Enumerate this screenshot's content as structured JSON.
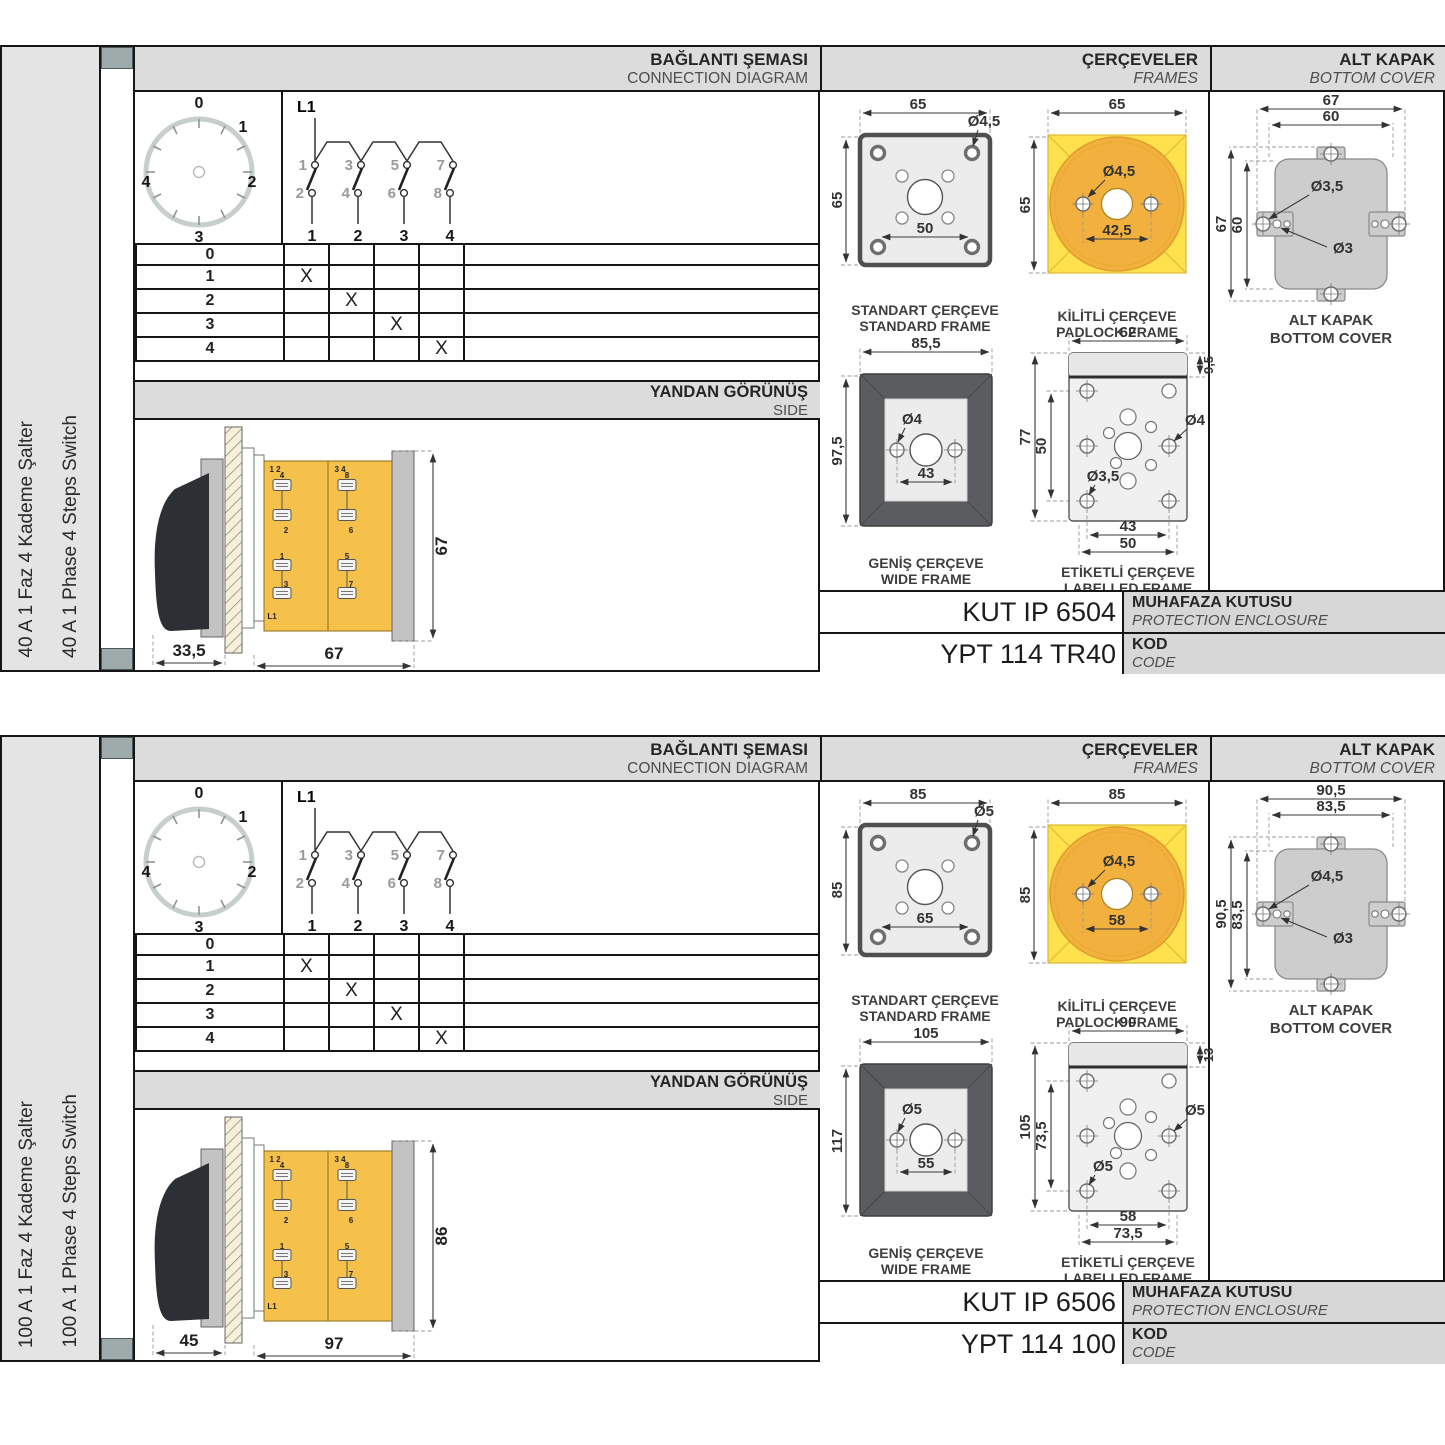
{
  "panels": [
    {
      "vertical_label_tr": "40 A 1 Faz 4 Kademe Şalter",
      "vertical_label_en": "40 A 1 Phase 4 Steps Switch",
      "headers": {
        "conn_tr": "BAĞLANTI ŞEMASI",
        "conn_en": "CONNECTION DIAGRAM",
        "frames_tr": "ÇERÇEVELER",
        "frames_en": "FRAMES",
        "cover_tr": "ALT KAPAK",
        "cover_en": "BOTTOM COVER"
      },
      "connection": {
        "dial_positions": [
          "0",
          "1",
          "2",
          "3",
          "4"
        ],
        "feed_label": "L1",
        "contact_top_numbers": [
          "1",
          "3",
          "5",
          "7"
        ],
        "contact_bottom_numbers": [
          "2",
          "4",
          "6",
          "8"
        ],
        "pole_numbers": [
          "1",
          "2",
          "3",
          "4"
        ],
        "table_rows": [
          {
            "step": "0",
            "marks": [
              "",
              "",
              "",
              ""
            ]
          },
          {
            "step": "1",
            "marks": [
              "X",
              "",
              "",
              ""
            ]
          },
          {
            "step": "2",
            "marks": [
              "",
              "X",
              "",
              ""
            ]
          },
          {
            "step": "3",
            "marks": [
              "",
              "",
              "X",
              ""
            ]
          },
          {
            "step": "4",
            "marks": [
              "",
              "",
              "",
              "X"
            ]
          }
        ]
      },
      "side_view": {
        "title_tr": "YANDAN GÖRÜNÜŞ",
        "title_en": "SIDE",
        "dim_depth_handle": "33,5",
        "dim_depth_body": "67",
        "dim_height": "67",
        "labels": {
          "pair_left": "1 2",
          "pair_right": "3 4",
          "t4": "4",
          "t2": "2",
          "t1": "1",
          "t3": "3",
          "t8": "8",
          "t6": "6",
          "t5": "5",
          "t7": "7",
          "feed": "L1"
        }
      },
      "frames": {
        "standard": {
          "cap_tr": "STANDART ÇERÇEVE",
          "cap_en": "STANDARD FRAME",
          "dim_w": "65",
          "dim_h": "65",
          "dim_hole": "Ø4,5",
          "dim_pitch": "50"
        },
        "padlock": {
          "cap_tr": "KİLİTLİ ÇERÇEVE",
          "cap_en": "PADLOCK FRAME",
          "dim_w": "65",
          "dim_h": "65",
          "dim_hole": "Ø4,5",
          "dim_pitch": "42,5"
        },
        "wide": {
          "cap_tr": "GENİŞ ÇERÇEVE",
          "cap_en": "WIDE FRAME",
          "dim_w": "85,5",
          "dim_h": "97,5",
          "dim_hole": "Ø4",
          "dim_pitch": "43"
        },
        "labelled": {
          "cap_tr": "ETİKETLİ ÇERÇEVE",
          "cap_en": "LABELLED FRAME",
          "dim_w": "62",
          "dim_band": "9,5",
          "dim_h": "77",
          "dim_pitch_v": "50",
          "dim_hole_side": "Ø4",
          "dim_hole_corner": "Ø3,5",
          "dim_pitch_inner": "43",
          "dim_pitch_outer": "50"
        }
      },
      "bottom_cover": {
        "cap_tr": "ALT KAPAK",
        "cap_en": "BOTTOM COVER",
        "dim_w_outer": "67",
        "dim_w_inner": "60",
        "dim_h_outer": "67",
        "dim_h_inner": "60",
        "dim_hole_big": "Ø3,5",
        "dim_hole_small": "Ø3"
      },
      "enclosure": {
        "value": "KUT IP 6504",
        "label_tr": "MUHAFAZA KUTUSU",
        "label_en": "PROTECTION ENCLOSURE"
      },
      "code": {
        "value": "YPT 114 TR40",
        "label_tr": "KOD",
        "label_en": "CODE"
      }
    },
    {
      "vertical_label_tr": "100 A 1 Faz 4 Kademe Şalter",
      "vertical_label_en": "100 A 1 Phase 4 Steps Switch",
      "headers": {
        "conn_tr": "BAĞLANTI ŞEMASI",
        "conn_en": "CONNECTION DIAGRAM",
        "frames_tr": "ÇERÇEVELER",
        "frames_en": "FRAMES",
        "cover_tr": "ALT KAPAK",
        "cover_en": "BOTTOM COVER"
      },
      "connection": {
        "dial_positions": [
          "0",
          "1",
          "2",
          "3",
          "4"
        ],
        "feed_label": "L1",
        "contact_top_numbers": [
          "1",
          "3",
          "5",
          "7"
        ],
        "contact_bottom_numbers": [
          "2",
          "4",
          "6",
          "8"
        ],
        "pole_numbers": [
          "1",
          "2",
          "3",
          "4"
        ],
        "table_rows": [
          {
            "step": "0",
            "marks": [
              "",
              "",
              "",
              ""
            ]
          },
          {
            "step": "1",
            "marks": [
              "X",
              "",
              "",
              ""
            ]
          },
          {
            "step": "2",
            "marks": [
              "",
              "X",
              "",
              ""
            ]
          },
          {
            "step": "3",
            "marks": [
              "",
              "",
              "X",
              ""
            ]
          },
          {
            "step": "4",
            "marks": [
              "",
              "",
              "",
              "X"
            ]
          }
        ]
      },
      "side_view": {
        "title_tr": "YANDAN GÖRÜNÜŞ",
        "title_en": "SIDE",
        "dim_depth_handle": "45",
        "dim_depth_body": "97",
        "dim_height": "86",
        "labels": {
          "pair_left": "1 2",
          "pair_right": "3 4",
          "t4": "4",
          "t2": "2",
          "t1": "1",
          "t3": "3",
          "t8": "8",
          "t6": "6",
          "t5": "5",
          "t7": "7",
          "feed": "L1"
        }
      },
      "frames": {
        "standard": {
          "cap_tr": "STANDART ÇERÇEVE",
          "cap_en": "STANDARD FRAME",
          "dim_w": "85",
          "dim_h": "85",
          "dim_hole": "Ø5",
          "dim_pitch": "65"
        },
        "padlock": {
          "cap_tr": "KİLİTLİ ÇERÇEVE",
          "cap_en": "PADLOCK FRAME",
          "dim_w": "85",
          "dim_h": "85",
          "dim_hole": "Ø4,5",
          "dim_pitch": "58"
        },
        "wide": {
          "cap_tr": "GENİŞ ÇERÇEVE",
          "cap_en": "WIDE FRAME",
          "dim_w": "105",
          "dim_h": "117",
          "dim_hole": "Ø5",
          "dim_pitch": "55"
        },
        "labelled": {
          "cap_tr": "ETİKETLİ ÇERÇEVE",
          "cap_en": "LABELLED FRAME",
          "dim_w": "90",
          "dim_band": "13",
          "dim_h": "105",
          "dim_pitch_v": "73,5",
          "dim_hole_side": "Ø5",
          "dim_hole_corner": "Ø5",
          "dim_pitch_inner": "58",
          "dim_pitch_outer": "73,5"
        }
      },
      "bottom_cover": {
        "cap_tr": "ALT KAPAK",
        "cap_en": "BOTTOM COVER",
        "dim_w_outer": "90,5",
        "dim_w_inner": "83,5",
        "dim_h_outer": "90,5",
        "dim_h_inner": "83,5",
        "dim_hole_big": "Ø4,5",
        "dim_hole_small": "Ø3"
      },
      "enclosure": {
        "value": "KUT IP 6506",
        "label_tr": "MUHAFAZA KUTUSU",
        "label_en": "PROTECTION ENCLOSURE"
      },
      "code": {
        "value": "YPT 114 100",
        "label_tr": "KOD",
        "label_en": "CODE"
      }
    }
  ]
}
